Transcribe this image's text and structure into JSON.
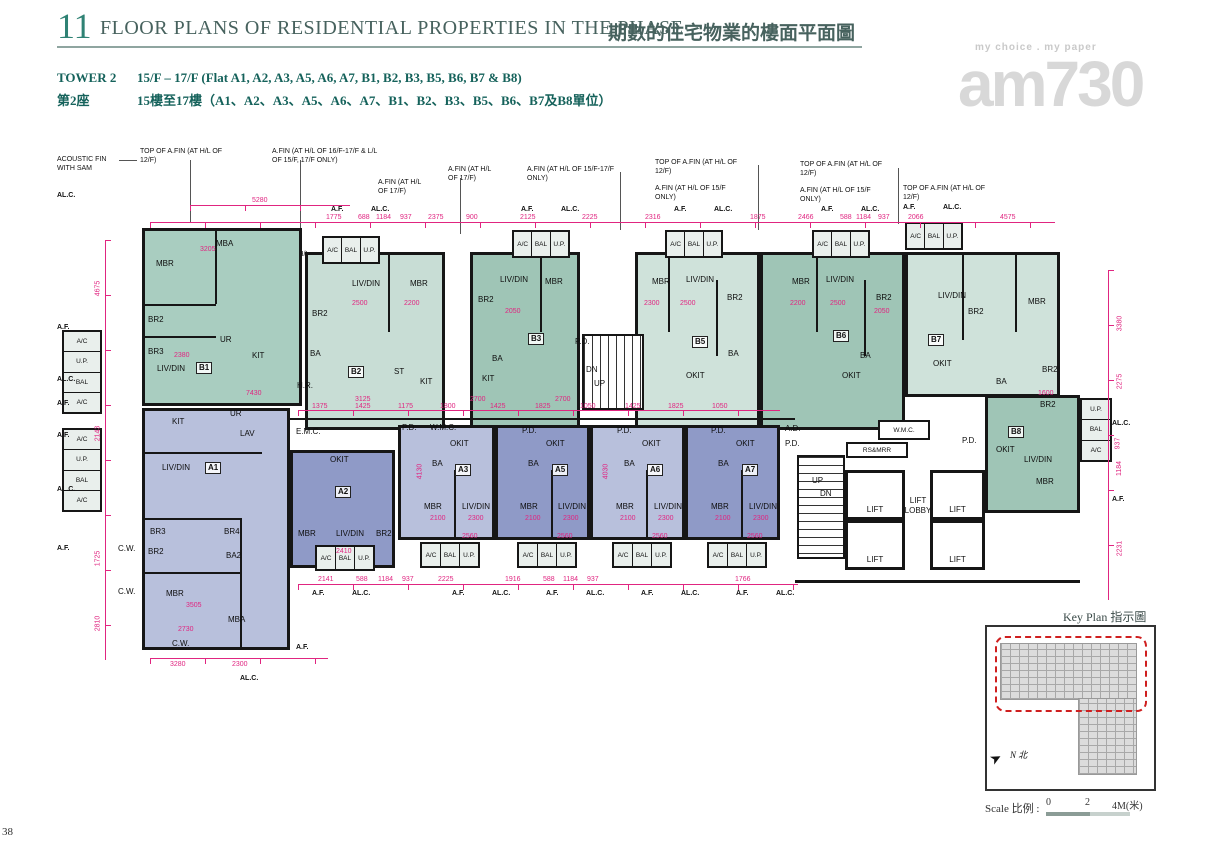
{
  "page_number": "38",
  "header": {
    "section_no": "11",
    "title_en": "FLOOR PLANS OF RESIDENTIAL PROPERTIES IN THE PHASE",
    "title_zh": "期數的住宅物業的樓面平面圖"
  },
  "tower": {
    "name_en": "TOWER 2",
    "floors_en": "15/F – 17/F (Flat A1, A2, A3, A5, A6, A7, B1, B2, B3, B5, B6, B7 & B8)",
    "name_zh": "第2座",
    "floors_zh": "15樓至17樓（A1、A2、A3、A5、A6、A7、B1、B2、B3、B5、B6、B7及B8單位）"
  },
  "watermark": {
    "tagline": "my choice . my paper",
    "logo": "am730"
  },
  "units": {
    "a1": "A1",
    "a2": "A2",
    "a3": "A3",
    "a5": "A5",
    "a6": "A6",
    "a7": "A7",
    "b1": "B1",
    "b2": "B2",
    "b3": "B3",
    "b5": "B5",
    "b6": "B6",
    "b7": "B7",
    "b8": "B8"
  },
  "labels": {
    "mbr": "MBR",
    "mba": "MBA",
    "br2": "BR2",
    "br3": "BR3",
    "br4": "BR4",
    "ba": "BA",
    "ba2": "BA2",
    "livdin": "LIV/DIN",
    "kit": "KIT",
    "okit": "OKIT",
    "st": "ST",
    "ur": "UR",
    "lav": "LAV",
    "bal": "BAL",
    "up": "U.P.",
    "ac": "A/C",
    "pd": "P.D.",
    "hr": "H.R.",
    "cw": "C.W.",
    "wmc": "W.M.C.",
    "emc": "E.M.C.",
    "ad": "A.D.",
    "rsmrr": "RS&MRR",
    "lift": "LIFT",
    "lift_lobby": "LIFT\nLOBBY",
    "stair_up": "UP",
    "stair_dn": "DN",
    "af": "A.F.",
    "alc": "AL.C."
  },
  "annotations": {
    "acoustic": "ACOUSTIC FIN WITH SAM",
    "top_afin_12": "TOP OF A.FIN (AT H/L OF 12/F)",
    "afin_1617": "A.FIN (AT H/L OF 16/F-17/F & L/L OF 15/F, 17/F ONLY)",
    "afin_17": "A.FIN (AT H/L OF 17/F)",
    "afin_1517": "A.FIN (AT H/L OF 15/F-17/F ONLY)",
    "afin_15": "A.FIN (AT H/L OF 15/F ONLY)"
  },
  "dims": {
    "top": [
      "5280",
      "1775",
      "688",
      "1184",
      "937",
      "2375",
      "900",
      "2125",
      "2225",
      "2316",
      "1875",
      "2466",
      "588",
      "1184",
      "937",
      "2066",
      "4575"
    ],
    "left": [
      "4675",
      "2143",
      "1725",
      "2810"
    ],
    "right": [
      "3380",
      "2275",
      "937",
      "1184",
      "2231"
    ],
    "corridor": [
      "1375",
      "1425",
      "1175",
      "1800",
      "1425",
      "1825",
      "1050",
      "1425",
      "1825",
      "1050"
    ],
    "bottom": [
      "2141",
      "588",
      "1184",
      "937",
      "2225",
      "1916",
      "588",
      "1184",
      "937",
      "1766"
    ],
    "a1": [
      "3280",
      "2300"
    ],
    "inner": [
      "2500",
      "2300",
      "2200",
      "2100",
      "2050",
      "3205",
      "3505",
      "2730",
      "2380",
      "4130",
      "4030",
      "2560",
      "2410",
      "1600",
      "3125",
      "2700",
      "7430"
    ]
  },
  "keyplan": {
    "title": "Key Plan 指示圖",
    "north": "N 北"
  },
  "scale": {
    "label": "Scale 比例 :",
    "t0": "0",
    "t2": "2",
    "t4": "4M(米)"
  },
  "palette": {
    "dim_magenta": "#e02580",
    "green_light": "#cfe2da",
    "green_mid": "#a9cdc0",
    "green_dark": "#9fc5b6",
    "blue_light": "#b8c0dc",
    "blue_dark": "#8f9ac7",
    "header_teal": "#2f8274",
    "keyplan_red": "#cf1f1f"
  }
}
